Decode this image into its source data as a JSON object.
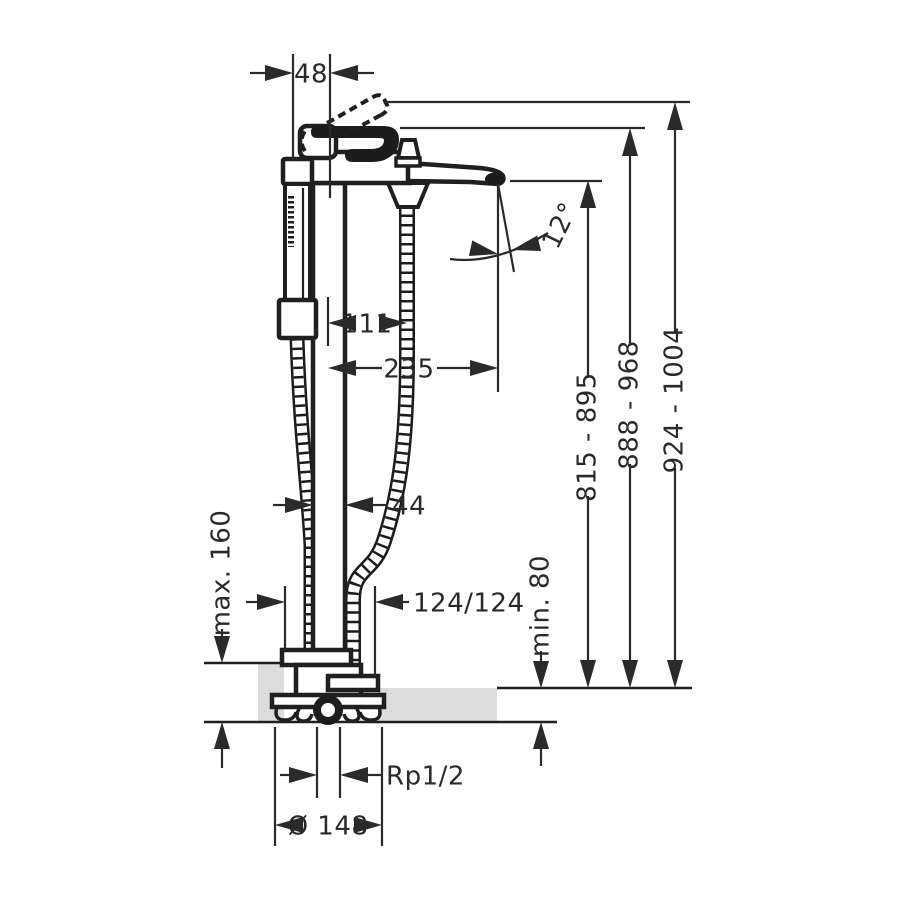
{
  "drawing": {
    "dimensions": {
      "handle_offset": "48",
      "hose_drop_offset": "111",
      "spout_reach": "235",
      "spout_angle": "12°",
      "spout_height_range": "815 - 895",
      "handle_height_range": "888 - 968",
      "total_height_range": "924 - 1004",
      "column_width": "44",
      "floor_buildup_max": "max. 160",
      "hose_connection": "124/124",
      "floor_buildup_min": "min. 80",
      "thread_size": "Rp1/2",
      "base_diameter": "Ø 148"
    },
    "colors": {
      "line": "#1f1f1f",
      "dimension_line": "#2a2a2a",
      "floor_fill": "#dcdcdc",
      "background": "#ffffff"
    }
  }
}
